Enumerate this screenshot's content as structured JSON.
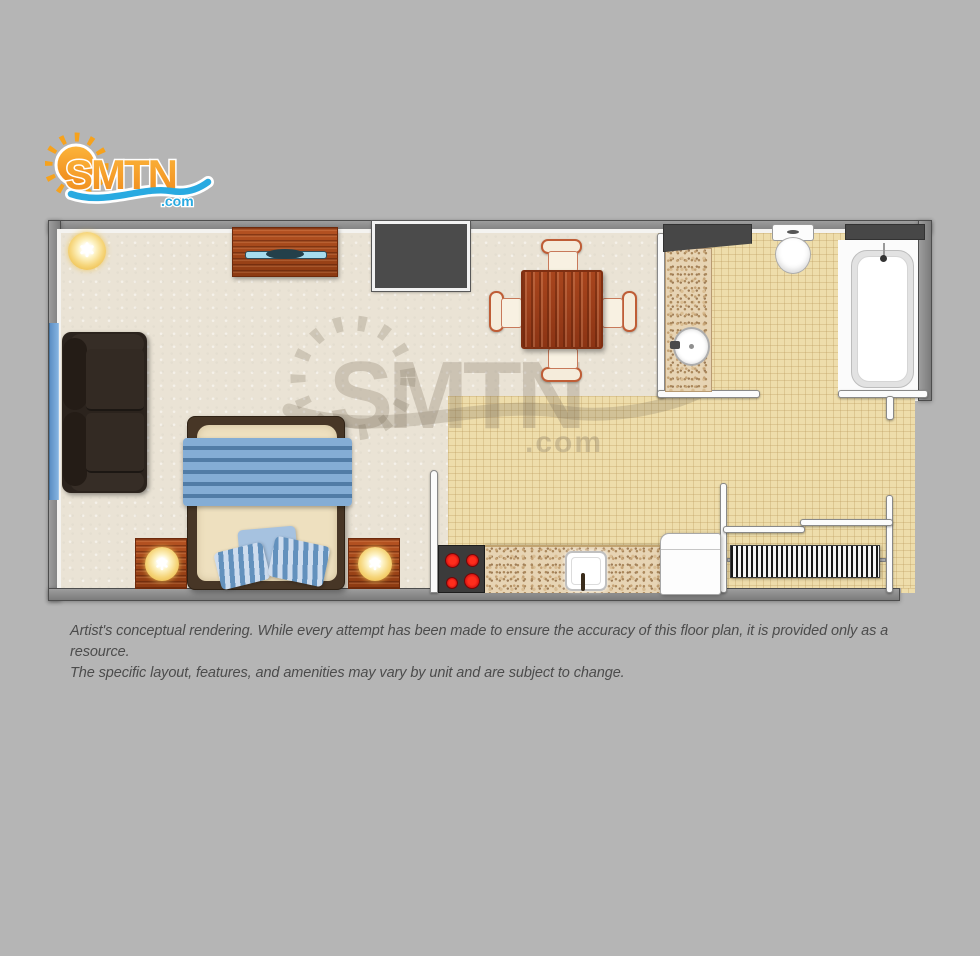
{
  "page": {
    "background_color": "#b5b5b5"
  },
  "logo": {
    "text": "SMTN",
    "tld": ".com",
    "orange_color": "#f6921e",
    "orange_light": "#fcb53b",
    "blue_color": "#29aae1"
  },
  "watermark": {
    "text": "SMTN",
    "tld": ".com",
    "color": "rgba(125,113,92,0.28)"
  },
  "disclaimer": {
    "line1": "Artist's conceptual rendering. While every attempt has been made to ensure the accuracy of this floor plan, it is provided only as a resource.",
    "line2": "The specific layout, features, and amenities may vary by unit and are subject to change."
  },
  "floorplan": {
    "rooms": [
      {
        "name": "living-sleeping-area",
        "floor": "carpet",
        "floor_color": "#eae3d5"
      },
      {
        "name": "kitchen-and-hallway",
        "floor": "tile",
        "floor_color": "#eeddab"
      },
      {
        "name": "bathroom",
        "floor": "tile",
        "floor_color": "#eeddab"
      }
    ],
    "fixtures": [
      {
        "name": "ceiling-lamp",
        "count": 1
      },
      {
        "name": "tv-dresser",
        "count": 1
      },
      {
        "name": "flat-screen-tv",
        "count": 1
      },
      {
        "name": "wall-closet",
        "count": 1
      },
      {
        "name": "dining-table",
        "count": 1
      },
      {
        "name": "dining-chair",
        "count": 4
      },
      {
        "name": "sofa",
        "count": 1
      },
      {
        "name": "window",
        "count": 1
      },
      {
        "name": "bed",
        "count": 1
      },
      {
        "name": "pillow",
        "count": 3
      },
      {
        "name": "nightstand",
        "count": 2
      },
      {
        "name": "table-lamp",
        "count": 2
      },
      {
        "name": "stove-cooktop",
        "count": 1
      },
      {
        "name": "burner",
        "count": 4
      },
      {
        "name": "kitchen-counter",
        "count": 1
      },
      {
        "name": "kitchen-sink",
        "count": 1
      },
      {
        "name": "refrigerator",
        "count": 1
      },
      {
        "name": "louvered-closet",
        "count": 1
      },
      {
        "name": "bathroom-vanity",
        "count": 1
      },
      {
        "name": "vanity-sink",
        "count": 1
      },
      {
        "name": "vanity-mirror",
        "count": 1
      },
      {
        "name": "toilet",
        "count": 1
      },
      {
        "name": "bathtub",
        "count": 1
      },
      {
        "name": "bathtub-window",
        "count": 1
      }
    ],
    "colors": {
      "wall_fill": "#8f8f8f",
      "wall_outline": "#4d4d4d",
      "wall_inner_lining": "#f4f3f0",
      "wood": "#a2451c",
      "sofa_brown": "#2b231d",
      "bedding_blue": "#84add5",
      "burner_red": "#cf1010",
      "lamp_yellow": "#f6d67c",
      "window_blue": "#6fa3d8"
    }
  }
}
